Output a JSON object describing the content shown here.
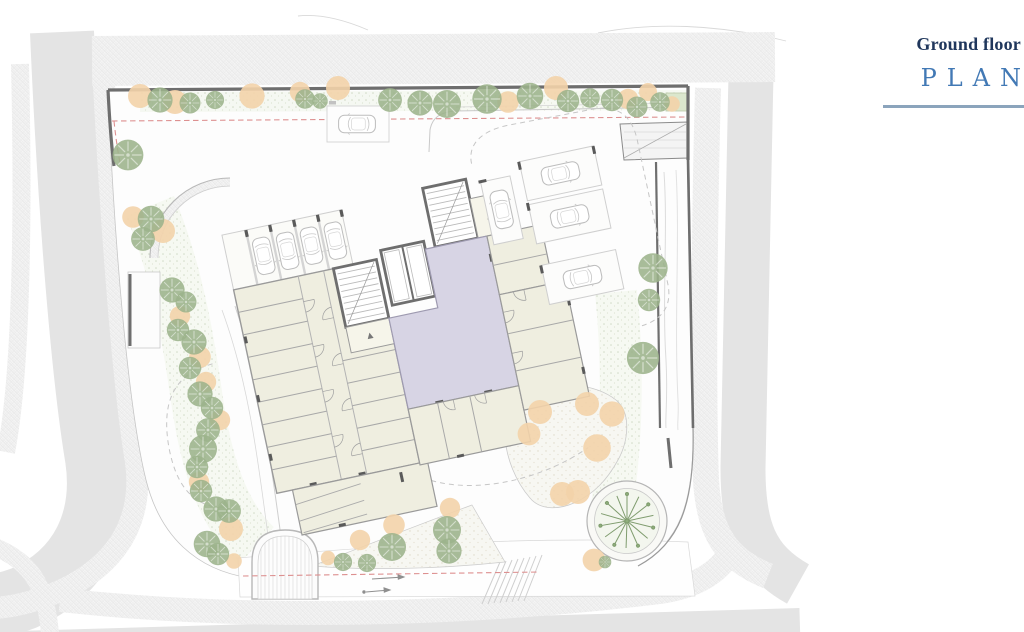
{
  "title_block": {
    "floor_label": "Ground floor",
    "plan_label": "PLAN"
  },
  "palette": {
    "road": "#e4e4e4",
    "wall": "#6e6e6e",
    "tree": "#9cb38b",
    "shrub": "#f3d3aa",
    "cream": "#efeee0",
    "lavender": "#d7d4e4",
    "planting_bed": "#dbe7cd",
    "setback_red": "#dd9090",
    "title_navy": "#20375c",
    "title_blue": "#4279b5",
    "rule_blue": "#8ba4bc"
  }
}
